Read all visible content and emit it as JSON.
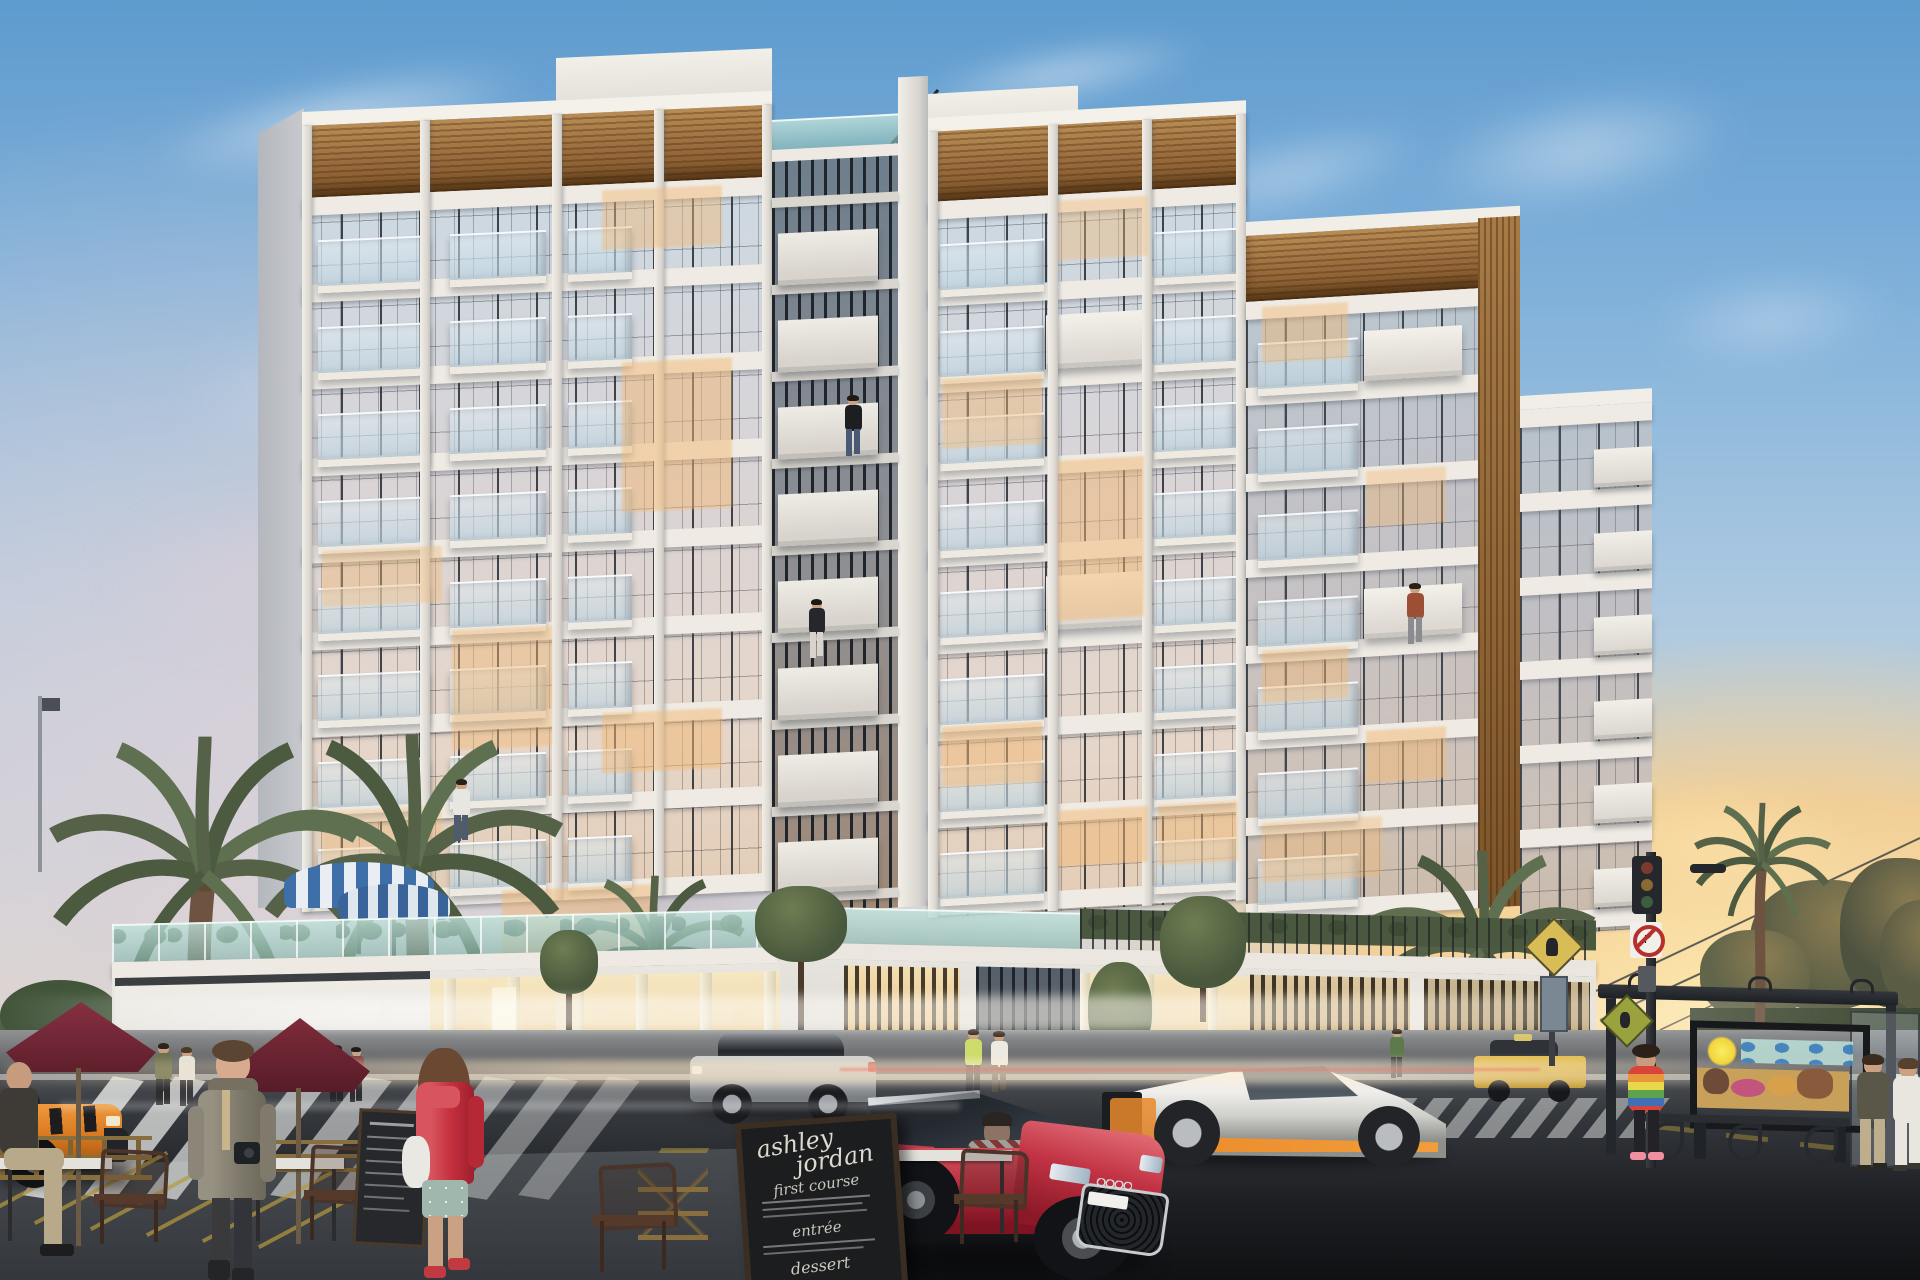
{
  "scene": {
    "description": "Dusk architectural rendering of a modern white-and-wood apartment building with glass balconies, rooftop terrace, street-level cafe, bus stop and luxury cars",
    "time_of_day": "sunset"
  },
  "menu_board": {
    "title_line1": "ashley",
    "title_line2": "jordan",
    "section_1": "first course",
    "section_2": "entrée",
    "section_3": "dessert"
  },
  "colors": {
    "skyTop": "#5e9bce",
    "skyMid": "#a9c7e0",
    "sunset": "#f4cf96",
    "sunGlow": "#ffeab4",
    "cloudPink": "#d8c5cc",
    "white": "#e9e6e0",
    "whiteHi": "#f4f1ea",
    "shade": "#c2c3c8",
    "wood": "#ab7c46",
    "mullion": "#2b2f36",
    "glass": "#ccd9e4",
    "warm": "#f2c184",
    "teal": "#9dc4bc",
    "road": "#34373c",
    "roadDark": "#121316",
    "maroon": "#752a37",
    "redCar": "#b82c3d",
    "taxiOrange": "#e2862d",
    "taxiYellow": "#d9b13f",
    "silver": "#c2c5c8",
    "lamboWhite": "#e9e8e4",
    "lamboOrange": "#e98a2b",
    "yellowLine": "#c2a040",
    "palm": "#556247",
    "gold": "#8a6f3e",
    "chalk": "#ded9cf"
  },
  "objects": {
    "building": [
      "left tower",
      "center bay with roof trellis",
      "right tower",
      "right wings",
      "podium with parking garage",
      "rooftop pool terrace with striped umbrellas"
    ],
    "vehicles": [
      "red sports car with driver",
      "white supercar with orange stripe",
      "silver SUV",
      "orange taxi",
      "yellow taxi",
      "white car"
    ],
    "people": [
      "woman in trench coat with camera",
      "woman in red coat",
      "seated cafe patron",
      "pedestrian couples",
      "girl in tie-dye hoodie",
      "two women at bus stop",
      "residents on balconies"
    ],
    "street": [
      "maroon cafe umbrellas",
      "cafe tables and chairs",
      "A-frame chalkboard menu",
      "small menu board",
      "bus shelter with beach mural billboard",
      "bench",
      "traffic signal",
      "road signs",
      "crosswalks",
      "palm trees"
    ]
  }
}
